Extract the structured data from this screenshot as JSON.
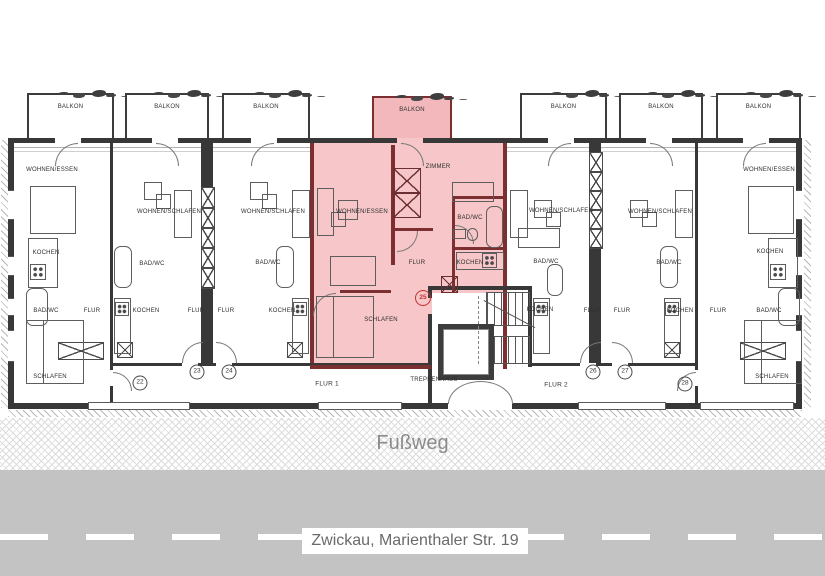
{
  "floorplan": {
    "balcony_labels": [
      "BALKON",
      "BALKON",
      "BALKON",
      "BALKON",
      "BALKON",
      "BALKON",
      "BALKON"
    ],
    "apartments": {
      "apt22": {
        "number": "22",
        "living": "WOHNEN/ESSEN",
        "kitchen": "KOCHEN",
        "bath": "BAD/WC",
        "hall": "FLUR",
        "bedroom": "SCHLAFEN"
      },
      "apt23": {
        "number": "23",
        "living": "WOHNEN/SCHLAFEN",
        "bath": "BAD/WC",
        "kitchen": "KOCHEN",
        "hall": "FLUR"
      },
      "apt24": {
        "number": "24",
        "living": "WOHNEN/SCHLAFEN",
        "bath": "BAD/WC",
        "kitchen": "KOCHEN",
        "hall": "FLUR"
      },
      "apt25": {
        "number": "25",
        "living": "WOHNEN/ESSEN",
        "room": "ZIMMER",
        "bath": "BAD/WC",
        "hall": "FLUR",
        "kitchen": "KOCHEN",
        "bedroom": "SCHLAFEN",
        "highlighted": true
      },
      "apt26": {
        "number": "26",
        "living": "WOHNEN/SCHLAFEN",
        "bath": "BAD/WC",
        "kitchen": "KOCHEN",
        "hall": "FLUR"
      },
      "apt27": {
        "number": "27",
        "living": "WOHNEN/SCHLAFEN",
        "bath": "BAD/WC",
        "kitchen": "KOCHEN",
        "hall": "FLUR"
      },
      "apt28": {
        "number": "28",
        "living": "WOHNEN/ESSEN",
        "kitchen": "KOCHEN",
        "bath": "BAD/WC",
        "hall": "FLUR",
        "bedroom": "SCHLAFEN"
      }
    },
    "common": {
      "stairwell": "TREPPENHAUS",
      "corridor1": "FLUR 1",
      "corridor2": "FLUR 2"
    },
    "footpath_label": "Fußweg",
    "street_label": "Zwickau, Marienthaler Str. 19",
    "colors": {
      "highlight_fill": "#f6c6c8",
      "highlight_balcony": "#f3b8bb",
      "highlight_wall": "#7b2f31",
      "marker_red": "#c5302f",
      "street_gray": "#c3c3c4"
    }
  }
}
